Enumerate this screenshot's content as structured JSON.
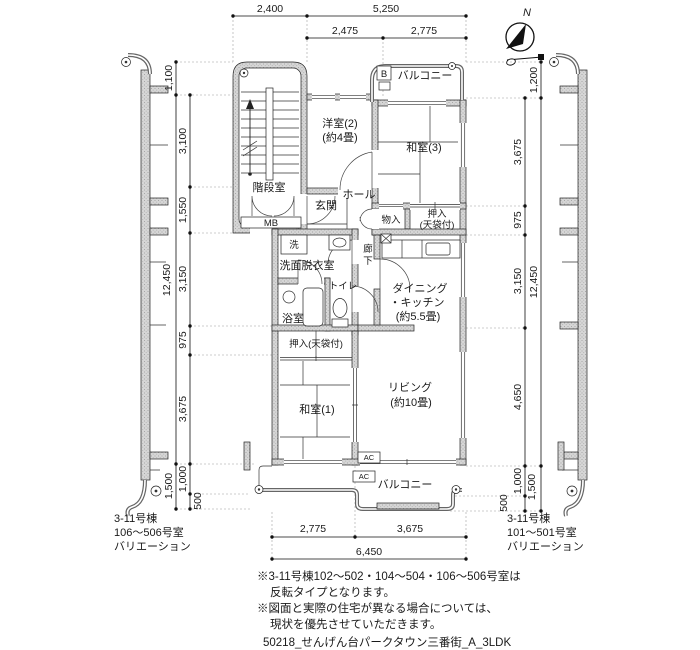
{
  "compass": {
    "north": "N"
  },
  "dims": {
    "top_row1": [
      "2,400",
      "5,250"
    ],
    "top_row2": [
      "2,475",
      "2,775"
    ],
    "left_outer": [
      "1,100",
      "12,450",
      "1,500"
    ],
    "left_inner": [
      "3,100",
      "1,550",
      "3,150",
      "975",
      "3,675",
      "1,000",
      "500"
    ],
    "right_outer": [
      "1,200",
      "12,450",
      "1,500"
    ],
    "right_inner": [
      "3,675",
      "975",
      "3,150",
      "4,650",
      "1,000",
      "500"
    ],
    "bottom_row1": [
      "2,775",
      "3,675"
    ],
    "bottom_total": "6,450"
  },
  "rooms": {
    "stairwell": "階段室",
    "mb": "MB",
    "western2": "洋室(2)",
    "western2_size": "(約4畳)",
    "japanese3": "和室(3)",
    "balcony_top": "バルコニー",
    "balcony_marker": "B",
    "entrance": "玄関",
    "hall": "ホール",
    "storage": "物入",
    "closet_upper_1": "押入",
    "closet_upper_2": "(天袋付)",
    "washer": "洗",
    "washroom": "洗面脱衣室",
    "toilet": "トイレ",
    "bath": "浴室",
    "corridor_a": "廊",
    "corridor_b": "下",
    "dk_1": "ダイニング",
    "dk_2": "・キッチン",
    "dk_3": "(約5.5畳)",
    "closet_lower": "押入(天袋付)",
    "japanese1": "和室(1)",
    "living_1": "リビング",
    "living_2": "(約10畳)",
    "balcony_bottom": "バルコニー",
    "ac_indoor": "AC",
    "ac_outdoor": "AC"
  },
  "annotations": {
    "left_variation": [
      "3-11号棟",
      "106〜506号室",
      "バリエーション"
    ],
    "right_variation": [
      "3-11号棟",
      "101〜501号室",
      "バリエーション"
    ],
    "notes": [
      "※3-11号棟102〜502・104〜504・106〜506号室は",
      "反転タイプとなります。",
      "※図面と実際の住宅が異なる場合については、",
      "現状を優先させていただきます。"
    ],
    "footer": "50218_せんげん台パークタウン三番街_A_3LDK"
  }
}
